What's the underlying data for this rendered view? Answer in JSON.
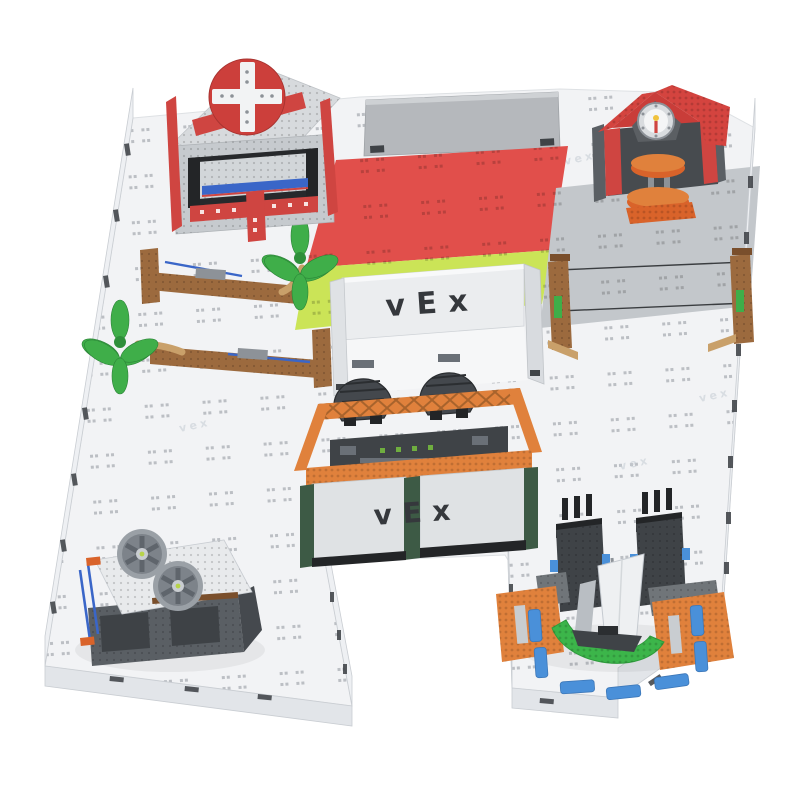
{
  "logos": {
    "enclosure": "vEx",
    "dam": "vEx",
    "watermark": "vex"
  },
  "colors": {
    "background": "#ffffff",
    "field": "#f2f3f5",
    "field_edge": "#d8dbdf",
    "wall": "#eef0f3",
    "wall_face": "#e2e5e9",
    "tab": "#3f4347",
    "panel_gray": "#b5b8bc",
    "mat_red": "#e14f4b",
    "mat_green": "#cbe457",
    "mat_gray": "#c3c7cb",
    "red": "#cf4541",
    "roof_red": "#d4443f",
    "red_dark": "#a83330",
    "dark": "#3f4347",
    "black": "#232527",
    "steel": "#5a5f64",
    "steel_light": "#8d9298",
    "white_part": "#e8eaec",
    "inner_panel": "#d2d6d9",
    "orange": "#e0813c",
    "orange_deep": "#d9632a",
    "brown": "#9c6a3e",
    "brown_dark": "#7a4f2c",
    "tan": "#c9a06a",
    "leaf_green": "#3fae49",
    "leaf_dark": "#2e8f3a",
    "hull_green": "#3cb54a",
    "column_green": "#3d5a45",
    "blue": "#3a66c8",
    "tile_blue": "#4a90d9",
    "logo_dark": "#35383c",
    "sail": "#eef0f2",
    "watermark": "#c4cad1"
  },
  "objects": {
    "field": "white interlocking tile field, H-shaped, low perimeter walls",
    "hospital": "gray building with red cross discs and blue bar, top-left",
    "backdrop_panel": "plain gray standing wall, top-center",
    "mats": [
      "red tile mat",
      "yellow-green tile mat",
      "gray tile mat"
    ],
    "firehouse": "red gabled building with white gauge and orange hydrant, top-right",
    "enclosure": "white VEX-branded wall enclosure, center",
    "dam": "orange truss bridge with two dark turbines and VEX front panel, center",
    "barriers": "two brown log barriers with green palm fronds, left",
    "zipline": "two brown posts with twin wires, right",
    "ramp": "gray ramp platform with two gray fan wheels, bottom-left",
    "dock": "orange docks, blue tiles, two dark towers and green sailboat, bottom-right"
  }
}
